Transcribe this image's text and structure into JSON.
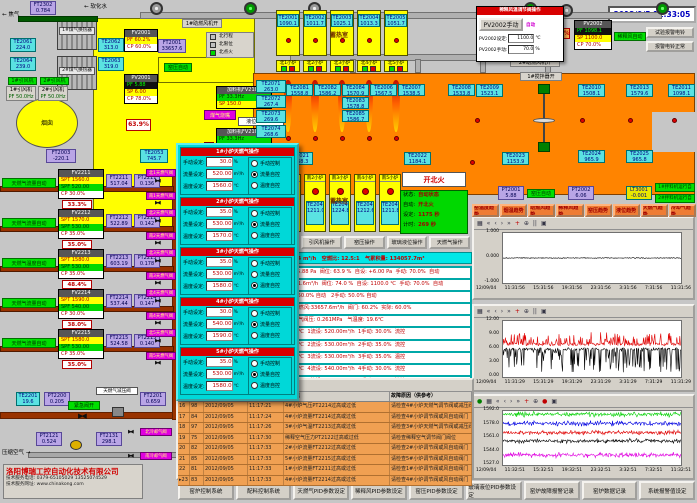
{
  "datetime": "2012/9/5 11:33:05",
  "topLeft": {
    "ft2302": {
      "tag": "FT2302",
      "val": "0.784"
    },
    "gasLabel": "焦气",
    "softWater": "软化水",
    "hx1": "1#煤气换热器",
    "hx2": "2#煤气换热器",
    "te2061": {
      "tag": "TE2061",
      "val": "224.0"
    },
    "te2064": {
      "tag": "TE2064",
      "val": "239.0"
    },
    "te2062": {
      "tag": "TE2062",
      "val": "313.0"
    },
    "te2063": {
      "tag": "TE2063",
      "val": "319.0"
    },
    "fan1Open": "1#引风机开",
    "fan2Open": "2#引风机开",
    "fan1": {
      "label": "1#引风机",
      "pf": "PF 50.0Hz"
    },
    "fan2": {
      "label": "2#引风机",
      "pf": "PF 50.0Hz"
    },
    "chimney": "烟囱",
    "ft2003": {
      "tag": "FT2003",
      "val": "-220.1"
    },
    "te2053": {
      "tag": "TE2053",
      "val": "745.7"
    },
    "valvePct": "63.9%",
    "blower1Open": "1#助燃风机开",
    "blower2Open": "2#助燃风机开",
    "stirrerOpen": "1#搅拌器开",
    "fv2001": {
      "tag": "FV2001",
      "rows": [
        "PF 60.2%",
        "CP 60.0%"
      ]
    },
    "ft2001": {
      "tag": "FT2001",
      "val": "33657.6"
    },
    "pv2001": {
      "tag": "PV2001",
      "rows": [
        "PF 5.88",
        "SP 6.00",
        "CP 78.0%"
      ]
    },
    "yaoPressureAuto": "窑压自动",
    "combAirOpen": "助燃风开",
    "burnerLabel": "煤气烧嘴",
    "legend": [
      "北行程",
      "北限位",
      "北点火"
    ],
    "charger1": {
      "title": "加料机FV2101",
      "rows": [
        "PF 33.3Hz",
        "SP 150.0"
      ]
    },
    "charger2": {
      "title": "加料机FV2102",
      "rows": [
        "PF 33.3Hz",
        "SP 150.0"
      ]
    },
    "level": "液位: -0.001"
  },
  "dilutionPopup": {
    "title": "稀释风温调节阀操作",
    "manBtn": "PV2002手动",
    "mode": "自动",
    "setLabel": "PV2002设定:",
    "setVal": "1100.0",
    "setUnit": "℃",
    "manLabel": "PV2002手动:",
    "manVal": "70.0",
    "manUnit": "%"
  },
  "pv2002": {
    "tag": "PV2002",
    "rows": [
      "PF 1098.1",
      "SP 1100.0",
      "CP 70.0%"
    ]
  },
  "dilutionAuto": "稀释风自动",
  "ft2002": {
    "tag": "FT2002",
    "val": "6331.6"
  },
  "pct74": "74.0%",
  "bellTest": "试验报警电铃",
  "bellOk": "报警电铃正常",
  "north": {
    "room": "蓄热室",
    "chambers": [
      {
        "te": "TE2001",
        "val": "1090.1",
        "burner": "北1小炉"
      },
      {
        "te": "TE2002",
        "val": "1011.7",
        "burner": "北2小炉"
      },
      {
        "te": "TE2003",
        "val": "1025.1",
        "burner": "北3小炉"
      },
      {
        "te": "TE2004",
        "val": "1013.3",
        "burner": "北4小炉"
      },
      {
        "te": "TE2005",
        "val": "1051.7",
        "burner": "北5小炉"
      }
    ]
  },
  "south": {
    "room": "蓄热室",
    "chambers": [
      {
        "burner": "南1小炉",
        "te": "TE2041",
        "val": "1209.6"
      },
      {
        "burner": "南2小炉",
        "te": "TE2042",
        "val": "1211.0"
      },
      {
        "burner": "南3小炉",
        "te": "TE2043",
        "val": "1224.8"
      },
      {
        "burner": "南4小炉",
        "te": "TE2044",
        "val": "1212.6"
      },
      {
        "burner": "南5小炉",
        "te": "TE2045",
        "val": "1211.8"
      }
    ]
  },
  "furnace": {
    "leftTe": [
      [
        "TE2071",
        "263.0"
      ],
      [
        "TE2072",
        "267.4"
      ],
      [
        "TE2073",
        "269.6"
      ],
      [
        "TE2074",
        "268.6"
      ]
    ],
    "flameTe": [
      [
        "TE2081",
        "1558.8"
      ],
      [
        "TE2082",
        "1586.2"
      ],
      [
        "TE2084",
        "1570.9"
      ],
      [
        "TE2083",
        "1578.8"
      ],
      [
        "TE2085",
        "1586.7"
      ],
      [
        "TE2006",
        "1567.5"
      ],
      [
        "TE2007",
        "1538.5"
      ],
      [
        "TE2008",
        "1533.8"
      ]
    ],
    "bottomTe": [
      [
        "TE2021",
        "1168.3"
      ],
      [
        "TE2022",
        "1184.1"
      ],
      [
        "TE2023",
        "1153.9"
      ]
    ],
    "rightTe": [
      [
        "TE2009",
        "1523.1"
      ],
      [
        "TE2010",
        "1508.1"
      ],
      [
        "TE2013",
        "1579.6"
      ],
      [
        "TE2011",
        "1098.1"
      ],
      [
        "TE2024",
        "965.9"
      ],
      [
        "TE2025",
        "965.8"
      ]
    ]
  },
  "fireStatus": {
    "headline": "开北火",
    "rows": [
      [
        "状态:",
        "自动状态"
      ],
      [
        "自动:",
        "开北火"
      ],
      [
        "设定:",
        "1175 秒"
      ],
      [
        "计时:",
        "269 秒"
      ]
    ]
  },
  "opButtons": [
    "助燃风操作",
    "稀释风操作",
    "引风机操作",
    "窑压操作",
    "玻璃液位操作",
    "天燃气操作"
  ],
  "trendButtons": [
    "窑温度趋势",
    "烟温趋势",
    "助燃风趋势",
    "稀释风趋势",
    "窑压趋势",
    "液位趋势",
    "天燃气趋势",
    "冷却气趋势"
  ],
  "pressure": {
    "pt2001": [
      "PT2001",
      "5.88"
    ],
    "auto": "窑压自动",
    "pt2002": [
      "PT2002",
      "6.06"
    ],
    "lt3001": [
      "LT3001",
      "-0.001"
    ],
    "mixer1": "1#拌料机运行自动",
    "mixer2": "2#拌料机运行自动"
  },
  "summaryBar": "助燃风量:33657.6 m³/h   天燃气总流量:2693.4 m³/h   空燃比: 12.5:1   气累积量: 134057.7m³",
  "statusRows": [
    "换火时间:  25 秒    窑压: +6.06 Pa  窑压设定: +5.88 Pa  阀位: 63.9 %  自设: +6.00 Pa  手动: 70.0%  自动",
    "换火时间:  25 秒    窑温: 1098.1℃  稀释风: 6331.6m³/h  阀位: 74.0 %  自设: 1100.0 ℃  手动: 70.0%  自动",
    "液位:  -0.001 mm   自设: +0.000 mm   1手动: 50.0% 自动   2手动: 50.0% 自动",
    "天燃气压力:0.794MPa   冷却气压: 298.1KPa   助燃风:33657.6m³/h  阀门: 60.2%  实际: 60.0%",
    "天燃气压力:0.524MPa   天燃气阀压:0.619MPa   气阀压: 0.261MPa   气温度: 19.6℃",
    "1压力:0.136MPa  1阀位: 33.3%  1温设:1560.0 ℃  1流设: 520.00m³/h  1手动: 30.0%  流控",
    "2压力:0.142MPa  2阀位: 35.0%  2温设:1570.0 ℃  2流设: 530.00m³/h  2手动: 35.0%  流控",
    "3压力:0.178MPa  3阀位: 48.4%  3温设:1580.0 ℃  3流设: 530.00m³/h  3手动: 35.0%  温控",
    "4压力:0.147MPa  4阀位: 38.0%  4温设:1590.0 ℃  4流设: 540.00m³/h  4手动: 30.0%  流控",
    "5压力:0.140MPa  5阀位: 35.0%  5温设:1580.0 ℃  5流设: 530.00m³/h  5手动: 35.0%  流控"
  ],
  "gasTrains": [
    {
      "auto": "天燃气流量自动",
      "fv": "FV2211",
      "spt": "SPT 1560.0",
      "spf": "SPF 520.00",
      "cp": "CP 30.0%",
      "pct": "33.3%",
      "ftTag": "FT2211",
      "ft": "517.04",
      "ptTag": "PT2211",
      "pt": "0.136",
      "vn": "北1天燃气阀",
      "vs": "南1天燃气阀"
    },
    {
      "auto": "天燃气流量自动",
      "fv": "FV2212",
      "spt": "SPT 1570.0",
      "spf": "SPF 530.00",
      "cp": "CP 35.0%",
      "pct": "35.0%",
      "ftTag": "FT2212",
      "ft": "522.89",
      "ptTag": "PT2212",
      "pt": "0.142",
      "vn": "北2天燃气阀",
      "vs": "南2天燃气阀"
    },
    {
      "auto": "天燃气温度自动",
      "fv": "FV2213",
      "spt": "SPT 1580.0",
      "spf": "SPF 530.00",
      "cp": "CP 35.0%",
      "pct": "48.4%",
      "ftTag": "FT2213",
      "ft": "603.19",
      "ptTag": "PT2213",
      "pt": "0.178",
      "vn": "北3天燃气阀",
      "vs": "南3天燃气阀"
    },
    {
      "auto": "天燃气流量自动",
      "fv": "FV2214",
      "spt": "SPT 1590.0",
      "spf": "SPF 540.00",
      "cp": "CP 30.0%",
      "pct": "38.0%",
      "ftTag": "FT2214",
      "ft": "537.44",
      "ptTag": "PT2214",
      "pt": "0.147",
      "vn": "北4天燃气阀",
      "vs": "南4天燃气阀"
    },
    {
      "auto": "天燃气流量自动",
      "fv": "FV2215",
      "spt": "SPT 1580.0",
      "spf": "SPF 530.00",
      "cp": "CP 35.0%",
      "pct": "35.0%",
      "ftTag": "FT2215",
      "ft": "524.58",
      "ptTag": "PT2215",
      "pt": "0.140",
      "vn": "北5天燃气阀",
      "vs": "南5天燃气阀"
    }
  ],
  "mainGas": {
    "te": [
      "TE2201",
      "19.6"
    ],
    "pt": [
      "PT2200",
      "0.205"
    ],
    "valveOpen": "紧急阀开",
    "reducer": "天燃气减压阀",
    "ft": [
      "FT2201",
      "0.659"
    ]
  },
  "airLine": {
    "label": "压缩空气",
    "pt": [
      "PT2121",
      "0.524"
    ],
    "ft": [
      "FT2131",
      "298.1"
    ],
    "vn": "北冷却气阀",
    "vs": "南冷却气阀"
  },
  "burnerPopup": {
    "fieldLabels": [
      "手动设定:",
      "流量设定:",
      "温度设定:"
    ],
    "units": [
      "%",
      "m³/h",
      "℃"
    ],
    "radios": [
      "手动控制",
      "流量自控",
      "温度自控"
    ],
    "panels": [
      {
        "title": "1#小炉天燃气操作",
        "manual": "30.0",
        "flow": "520.00",
        "temp": "1560.0",
        "mode": 1
      },
      {
        "title": "2#小炉天燃气操作",
        "manual": "35.0",
        "flow": "530.00",
        "temp": "1570.0",
        "mode": 1
      },
      {
        "title": "3#小炉天燃气操作",
        "manual": "35.0",
        "flow": "530.00",
        "temp": "1580.0",
        "mode": 2
      },
      {
        "title": "4#小炉天燃气操作",
        "manual": "30.0",
        "flow": "540.00",
        "temp": "1590.0",
        "mode": 1
      },
      {
        "title": "5#小炉天燃气操作",
        "manual": "35.0",
        "flow": "530.00",
        "temp": "1580.0",
        "mode": 1
      }
    ]
  },
  "alarmTable": {
    "headers": [
      "",
      "",
      "日期",
      "时间",
      "故障点",
      "故障原因（供参考）"
    ],
    "rows": [
      [
        "16",
        "98",
        "2012/09/05",
        "11:17:21",
        "4#小炉气压PT2214过高或过低",
        "请检查4#小炉天燃气调节阀或减压阀"
      ],
      [
        "17",
        "84",
        "2012/09/05",
        "11:17:24",
        "4#小炉流量FT2214过高或过低",
        "请检查4#小炉调节阀或风自动阀门"
      ],
      [
        "18",
        "97",
        "2012/09/05",
        "11:17:26",
        "3#小炉气温FT2213过高或过低",
        "请检查3#小炉天燃气调节阀或减压阀"
      ],
      [
        "19",
        "75",
        "2012/09/05",
        "11:17:30",
        "稀释空气压力PT2122过高或过低",
        "请检查稀释空气调节阀门阀位"
      ],
      [
        "20",
        "82",
        "2012/09/05",
        "11:17:33",
        "2#小炉流量FT2212过高或过低",
        "请检查2#小炉调节阀或风自动阀门"
      ],
      [
        "21",
        "85",
        "2012/09/05",
        "11:17:33",
        "5#小炉流量FT2215过高或过低",
        "请检查5#小炉调节阀或风自动阀门"
      ],
      [
        "22",
        "81",
        "2012/09/05",
        "11:17:33",
        "1#小炉流量FT2211过高或过低",
        "请检查1#小炉调节阀或风自动阀门"
      ],
      [
        "23",
        "83",
        "2012/09/05",
        "11:17:33",
        "4#小炉流量FT2214过高或过低",
        "请检查4#小炉调节阀或风自动阀门"
      ]
    ]
  },
  "bottomButtons": [
    "窑炉控制系统",
    "配料控制系统",
    "天燃气PID参数设定",
    "稀释风PID参数设定",
    "窑压PID参数设定",
    "玻璃液位PID参数设定",
    "窑炉故障报警记录",
    "窑炉数据记录",
    "系统报警值设定"
  ],
  "company": {
    "name": "洛阳博瑞工控自动化技术有限公司",
    "phone": "技术服务电话: 0379-65105029  13525074529",
    "web": "技术服务网址: www.chinakong.com"
  },
  "colors": {
    "furnace": "#ff8400",
    "duct": "#ffff00",
    "popup": "#00d8d8",
    "alarmRow": "#f0a052",
    "accentRed": "#d80000",
    "autoGreen": "#00d800"
  },
  "chart_data": [
    {
      "type": "line",
      "title": "窑压趋势",
      "ylim": [
        -1,
        1
      ],
      "yticks": [
        "1.000",
        "0.000",
        "-1.000"
      ],
      "xticks": [
        "12/09/04",
        "11:31:56",
        "15:31:56",
        "19:31:56",
        "23:31:56",
        "3:31:56",
        "7:31:56",
        "11:31:56"
      ],
      "toolbar": [
        "grid",
        "first",
        "prev",
        "next",
        "last",
        "mark",
        "zoom",
        "pause",
        "save"
      ],
      "series": [
        {
          "name": "窑压",
          "color": "#000000",
          "base": 0.0,
          "noise": 0.015,
          "spike": 0.0,
          "spikeProb": 0.0,
          "dir": 0
        }
      ]
    },
    {
      "type": "line",
      "title": "窑压/引风压力趋势",
      "ylim": [
        0,
        12
      ],
      "yticks": [
        "12.00",
        "9.00",
        "6.00",
        "3.00",
        "0.00"
      ],
      "xticks": [
        "12/09/04",
        "11:31:29",
        "15:31:29",
        "19:31:29",
        "23:31:29",
        "3:31:29",
        "7:31:29",
        "11:31:29"
      ],
      "toolbar": [
        "grid",
        "first",
        "prev",
        "next",
        "last",
        "mark",
        "zoom",
        "pause",
        "save"
      ],
      "series": [
        {
          "name": "红",
          "color": "#e00000",
          "base": 7.0,
          "noise": 0.3,
          "spike": 2.6,
          "spikeProb": 0.3,
          "dir": 1
        },
        {
          "name": "黑",
          "color": "#000000",
          "base": 6.0,
          "noise": 0.25,
          "spike": 5.0,
          "spikeProb": 0.35,
          "dir": -1
        }
      ]
    },
    {
      "type": "line",
      "title": "小炉温度趋势",
      "ylim": [
        1527,
        1592
      ],
      "yticks": [
        "1592.0",
        "1578.0",
        "1561.0",
        "1544.0",
        "1527.0"
      ],
      "xticks": [
        "12/09/04",
        "11:32:51",
        "15:32:51",
        "19:32:51",
        "23:32:51",
        "3:32:51",
        "7:32:51",
        "11:32:51"
      ],
      "toolbar": [
        "run",
        "grid",
        "first",
        "prev",
        "next",
        "last",
        "mark",
        "zoom",
        "stop",
        "save"
      ],
      "series": [
        {
          "name": "绿",
          "color": "#00d000",
          "base": 1588,
          "noise": 1.6,
          "spike": 3.5,
          "spikeProb": 0.3,
          "dir": 0
        },
        {
          "name": "蓝",
          "color": "#0000e0",
          "base": 1577,
          "noise": 1.6,
          "spike": 3.5,
          "spikeProb": 0.3,
          "dir": 0
        },
        {
          "name": "红",
          "color": "#e00000",
          "base": 1566,
          "noise": 1.4,
          "spike": 3.0,
          "spikeProb": 0.3,
          "dir": 0
        },
        {
          "name": "黑",
          "color": "#000000",
          "base": 1556,
          "noise": 1.4,
          "spike": 3.0,
          "spikeProb": 0.3,
          "dir": 0
        },
        {
          "name": "紫",
          "color": "#e000e0",
          "base": 1539,
          "noise": 1.6,
          "spike": 3.5,
          "spikeProb": 0.3,
          "dir": 0
        }
      ]
    }
  ]
}
